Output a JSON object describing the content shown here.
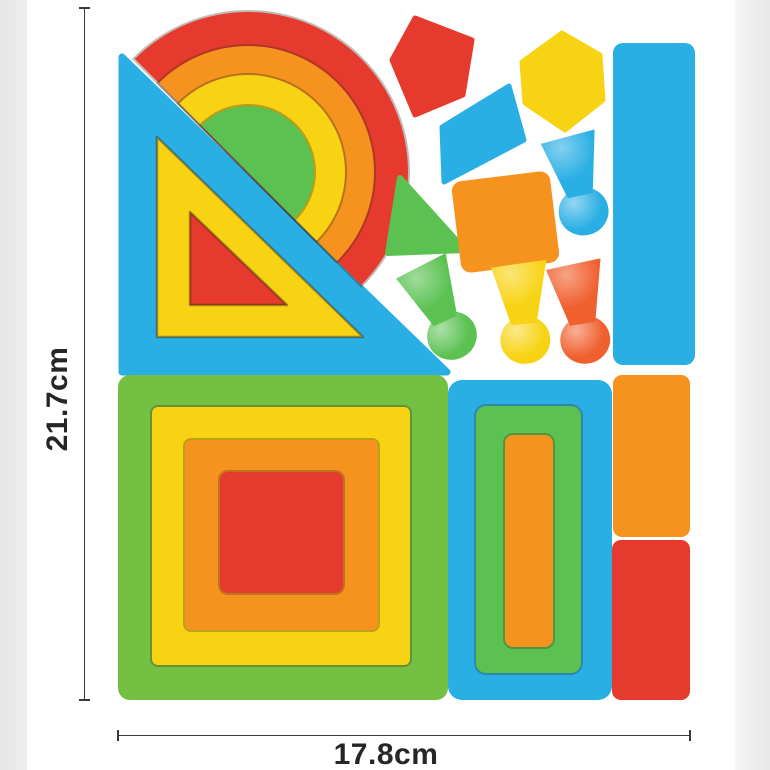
{
  "photo": {
    "description": "Rainbow wooden geometric stacking blocks toy set, top view with size annotations"
  },
  "dimensions": {
    "height_label": "21.7cm",
    "width_label": "17.8cm"
  },
  "palette": {
    "blue": "#2aafe4",
    "green": "#73c043",
    "green_bright": "#5bc252",
    "yellow": "#f8d314",
    "orange": "#f6921e",
    "red": "#e63a2e",
    "orange_red": "#f0602f",
    "background": "#ffffff",
    "gutter": "#ededed",
    "line": "#3a3a3a",
    "label": "#262626"
  },
  "pieces": [
    {
      "name": "rainbow-arch",
      "colors": [
        "red",
        "orange",
        "yellow",
        "green"
      ]
    },
    {
      "name": "nested-triangles",
      "colors": [
        "blue",
        "yellow",
        "red"
      ]
    },
    {
      "name": "nested-squares",
      "colors": [
        "green",
        "yellow",
        "orange",
        "red"
      ]
    },
    {
      "name": "nested-rectangles",
      "colors": [
        "blue",
        "green",
        "orange"
      ]
    },
    {
      "name": "tall-bar",
      "colors": [
        "blue"
      ]
    },
    {
      "name": "small-bars",
      "colors": [
        "orange",
        "red"
      ]
    },
    {
      "name": "pentagon",
      "colors": [
        "red"
      ]
    },
    {
      "name": "hexagon",
      "colors": [
        "yellow"
      ]
    },
    {
      "name": "diamond",
      "colors": [
        "blue"
      ]
    },
    {
      "name": "small-triangle",
      "colors": [
        "green"
      ]
    },
    {
      "name": "tilted-square",
      "colors": [
        "orange"
      ]
    },
    {
      "name": "pegs",
      "colors": [
        "blue",
        "green",
        "yellow",
        "orange-red"
      ]
    }
  ]
}
